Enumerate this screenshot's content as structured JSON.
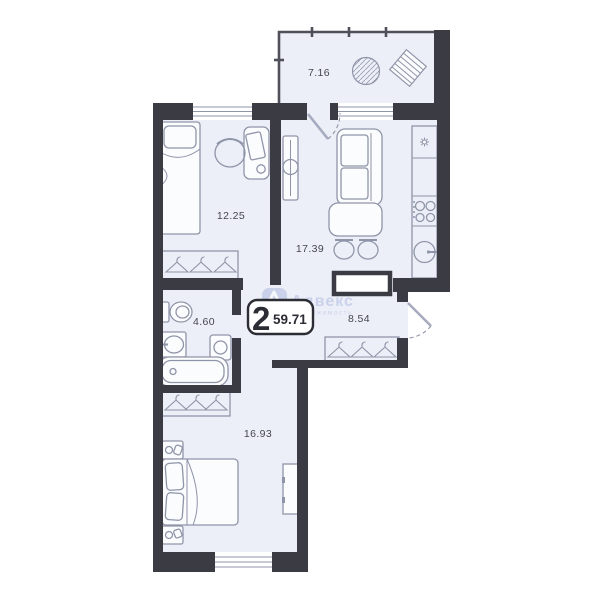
{
  "badge": {
    "rooms": "2",
    "area": "59.71"
  },
  "watermark": {
    "brand": "Адвекс",
    "sub": "недвижимость"
  },
  "rooms": [
    {
      "id": "balcony",
      "area_label": "7.16"
    },
    {
      "id": "bedroom-1",
      "area_label": "12.25"
    },
    {
      "id": "kitchen-living",
      "area_label": "17.39"
    },
    {
      "id": "bathroom",
      "area_label": "4.60"
    },
    {
      "id": "hallway",
      "area_label": "8.54"
    },
    {
      "id": "bedroom-2",
      "area_label": "16.93"
    }
  ],
  "colors": {
    "wall": "#3b3b43",
    "floor": "#edeff8",
    "line": "#8f95a8",
    "label": "#45454d",
    "badge": "#2c2c34",
    "watermark": "#a8b5dd"
  }
}
